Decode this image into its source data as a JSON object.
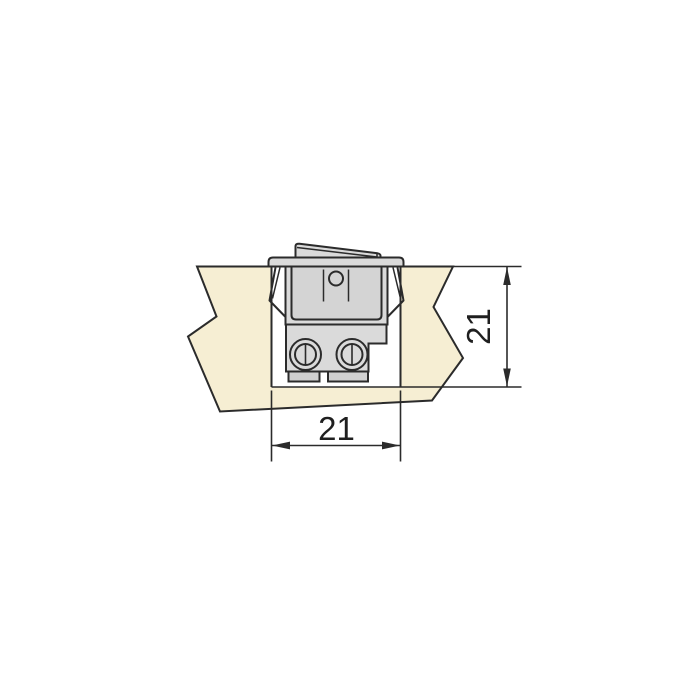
{
  "diagram": {
    "type": "technical-installation-drawing",
    "subject": "rocker-switch-mounted-in-panel-cutout",
    "dimensions": {
      "width_label": "21",
      "height_label": "21"
    },
    "colors": {
      "background": "#ffffff",
      "panel_fill": "#f6eed3",
      "cutout_fill": "#ffffff",
      "switch_fill": "#dadada",
      "switch_inner_fill": "#d4d4d4",
      "tab_fill": "#d0d0d0",
      "line": "#2b2b2b",
      "text": "#1f1f1f"
    }
  }
}
